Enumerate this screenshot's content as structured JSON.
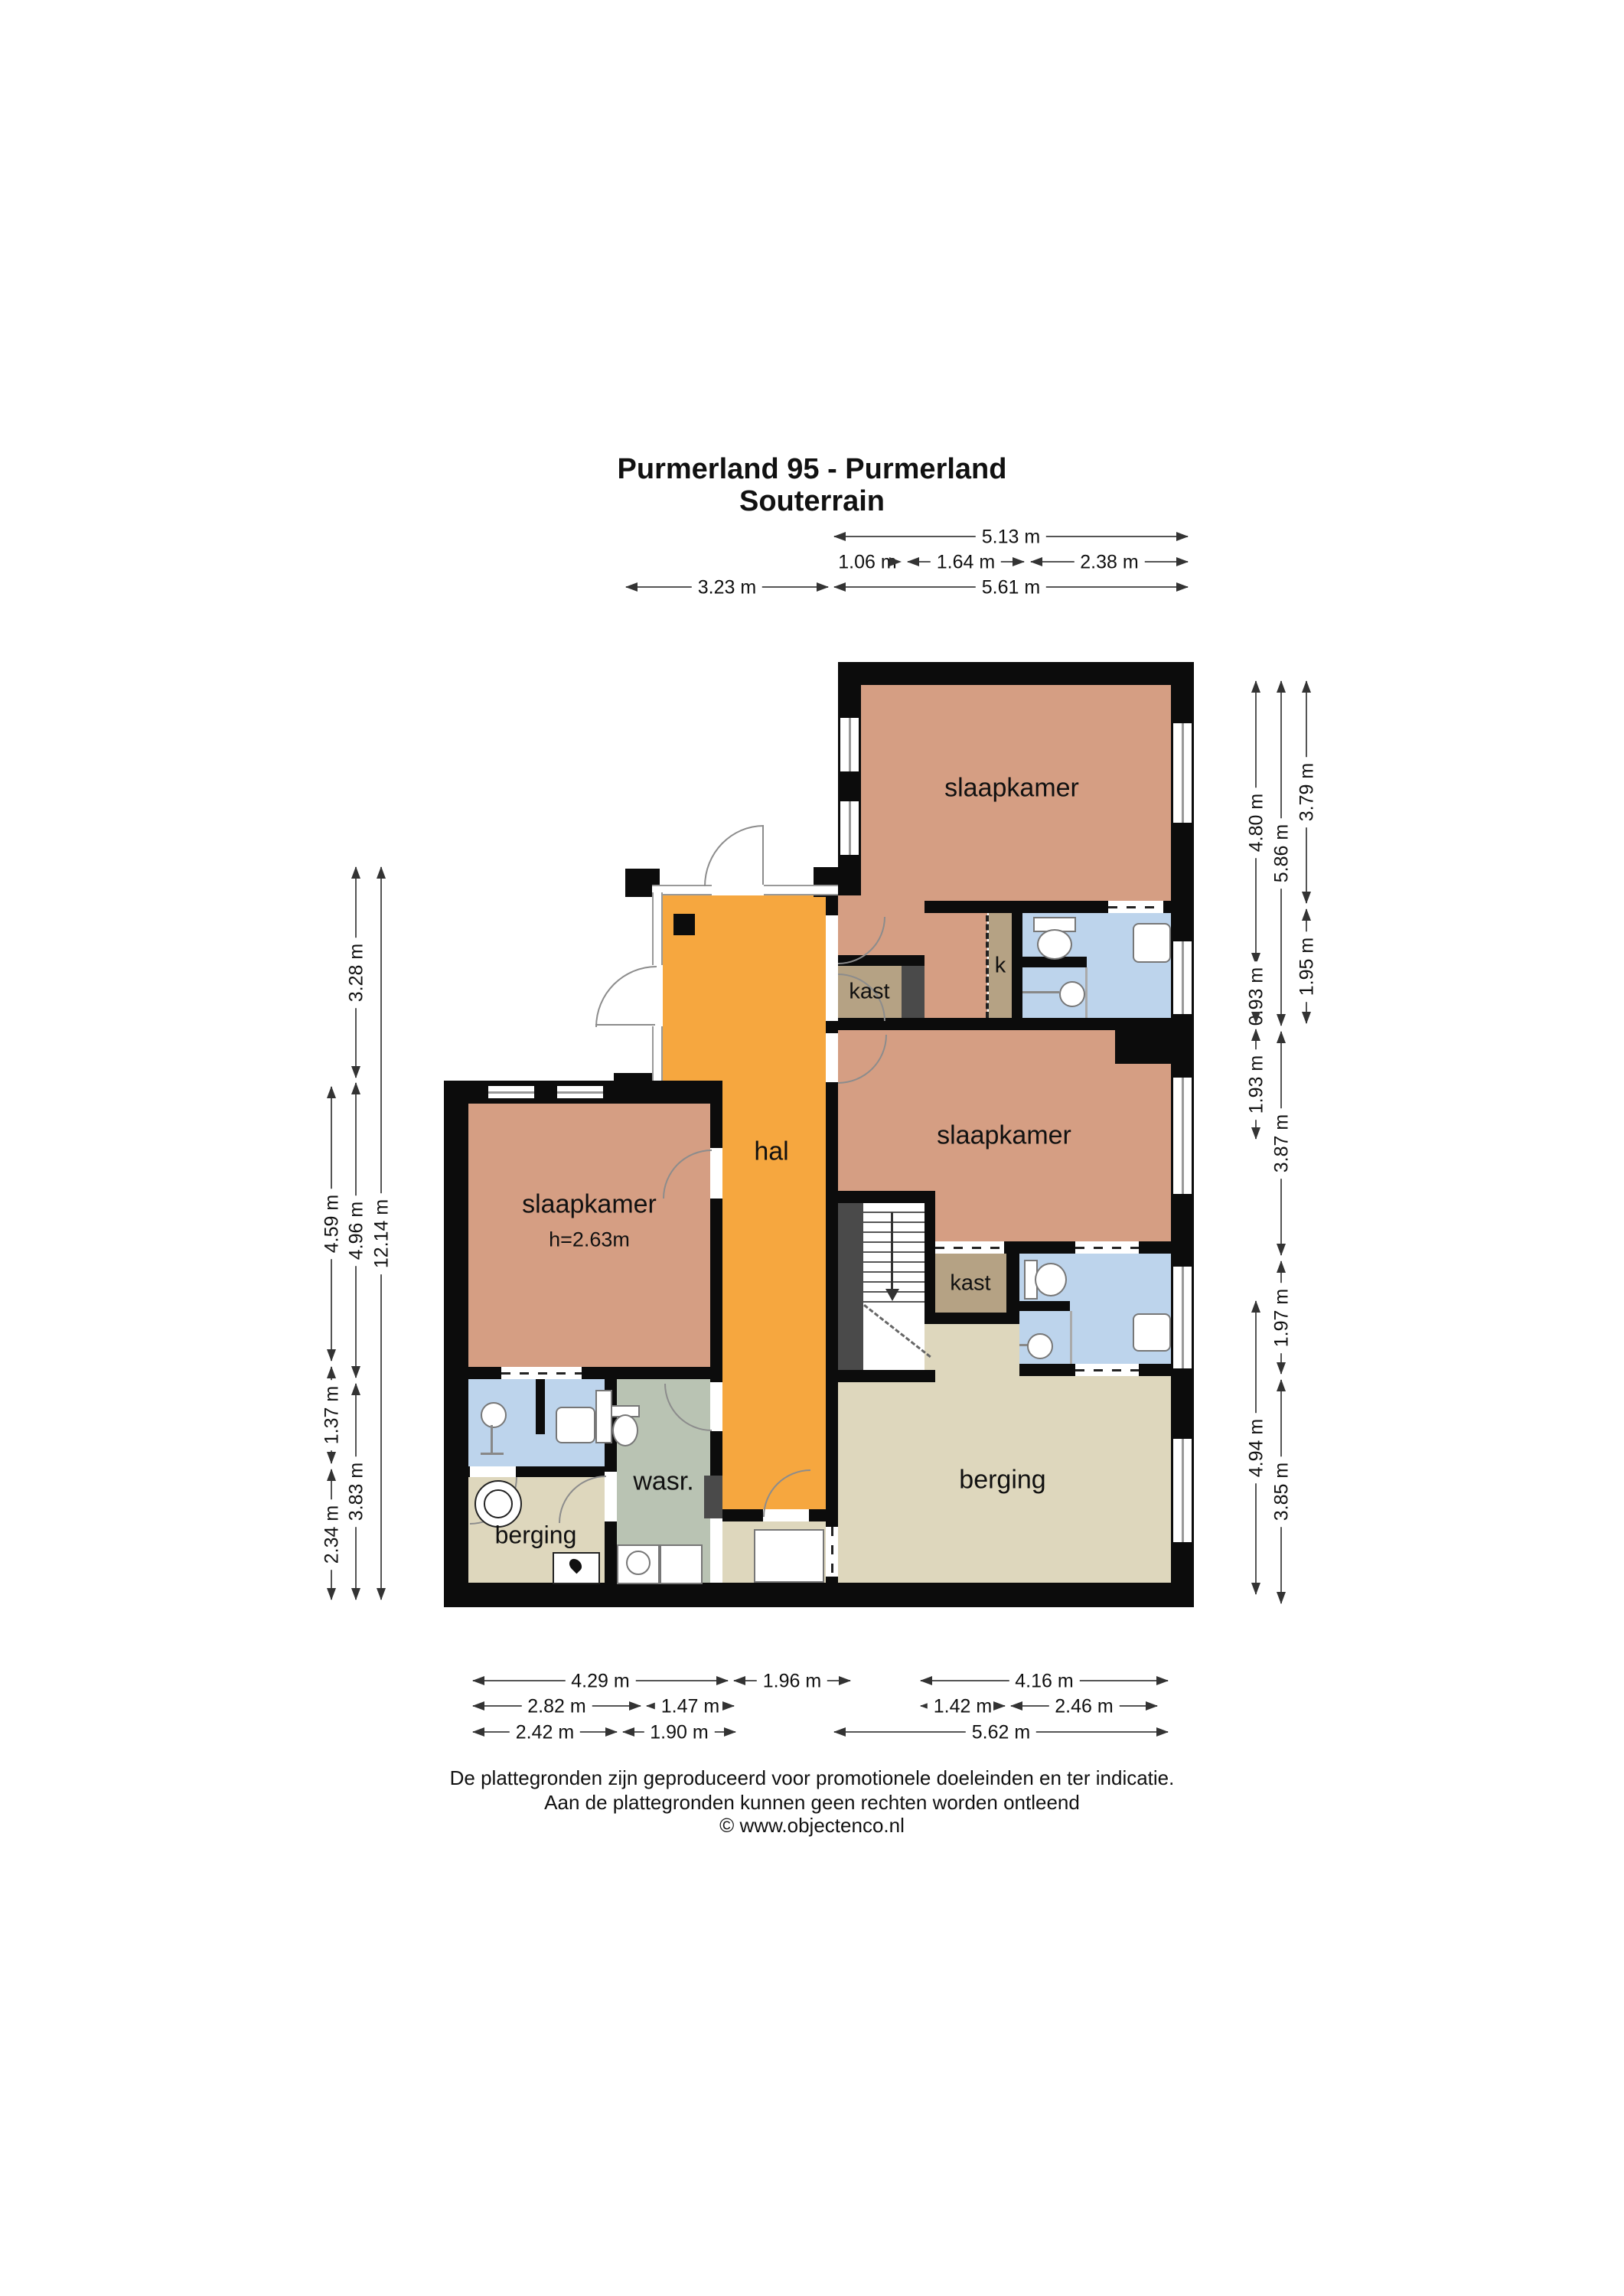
{
  "title": {
    "line1": "Purmerland 95 - Purmerland",
    "line2": "Souterrain"
  },
  "rooms": {
    "slaapkamer": "slaapkamer",
    "slaapkamer_height": "h=2.63m",
    "hal": "hal",
    "kast": "kast",
    "k": "k",
    "wasr": "wasr.",
    "berging": "berging"
  },
  "dimensions": {
    "top": [
      "5.13 m",
      "1.06 m",
      "1.64 m",
      "2.38 m",
      "3.23 m",
      "5.61 m"
    ],
    "left": [
      "3.28 m",
      "4.59 m",
      "4.96 m",
      "12.14 m",
      "1.37 m",
      "3.83 m",
      "2.34 m"
    ],
    "right": [
      "4.80 m",
      "5.86 m",
      "3.79 m",
      "0.93 m",
      "1.95 m",
      "1.93 m",
      "3.87 m",
      "1.97 m",
      "4.94 m",
      "3.85 m"
    ],
    "bottom": [
      "4.29 m",
      "1.96 m",
      "4.16 m",
      "2.82 m",
      "1.47 m",
      "1.42 m",
      "2.46 m",
      "2.42 m",
      "1.90 m",
      "5.62 m"
    ]
  },
  "footer": {
    "line1": "De plattegronden zijn geproduceerd voor promotionele doeleinden en ter indicatie.",
    "line2": "Aan de plattegronden kunnen geen rechten worden ontleend",
    "line3": "© www.objectenco.nl"
  },
  "palette": {
    "wall": "#0c0c0c",
    "bedroom": "#d59e83",
    "hall": "#f6a73f",
    "bathroom": "#bdd4ec",
    "closet": "#b5a284",
    "storage": "#ded7bd",
    "utility": "#b9c3b3",
    "glass": "#999999",
    "partition_dark": "#4a4a4a",
    "dimension_line": "#555555"
  }
}
